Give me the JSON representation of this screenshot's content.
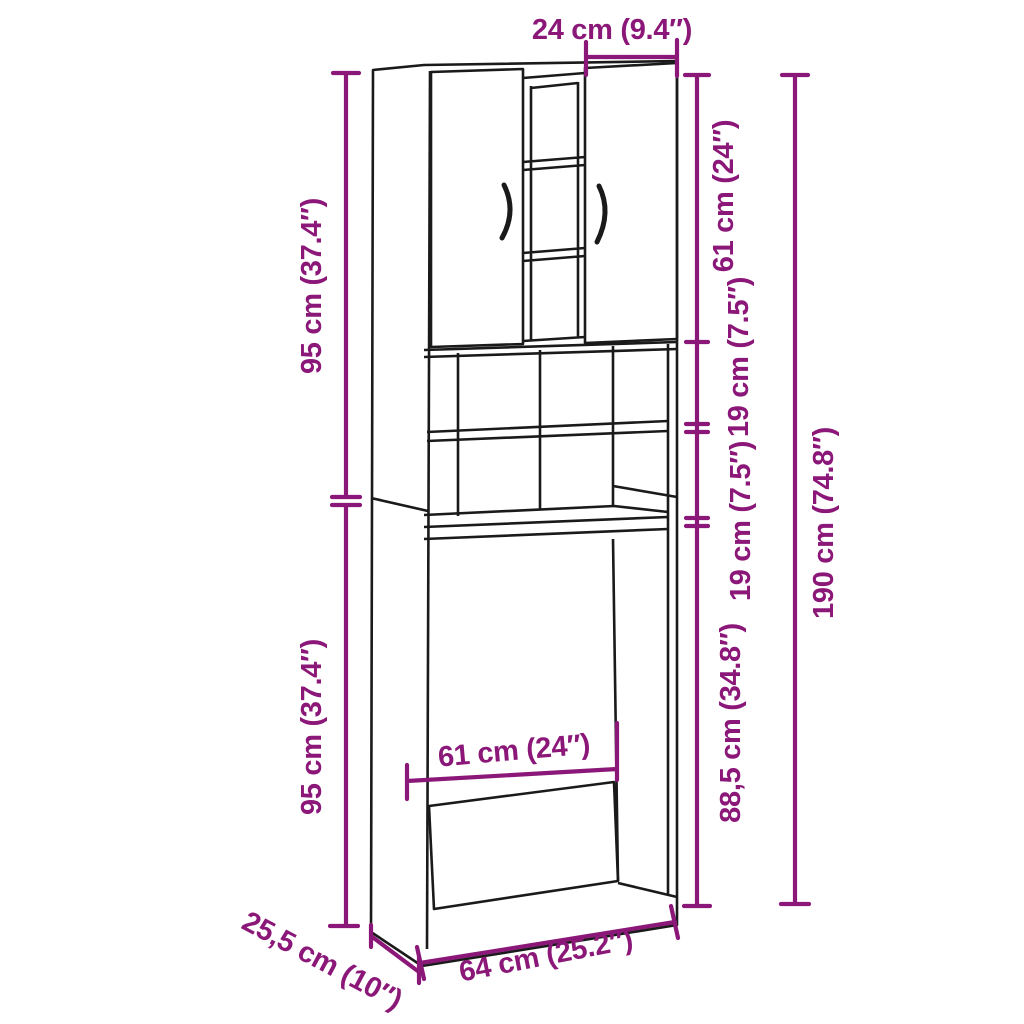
{
  "colors": {
    "dimension": "#8B1878",
    "line": "#1A1A1A",
    "background": "#FFFFFF"
  },
  "dimensions": {
    "top_width": "24 cm (9.4″)",
    "left_upper_height": "95 cm (37.4″)",
    "left_lower_height": "95 cm (37.4″)",
    "door_height": "61 cm (24″)",
    "shelf_gap_1": "19 cm (7.5″)",
    "shelf_gap_2": "19 cm (7.5″)",
    "machine_space_height": "88,5 cm (34.8″)",
    "total_height": "190 cm (74.8″)",
    "inner_width": "61 cm (24″)",
    "bottom_width": "64 cm (25.2″)",
    "depth": "25,5 cm (10″)"
  }
}
